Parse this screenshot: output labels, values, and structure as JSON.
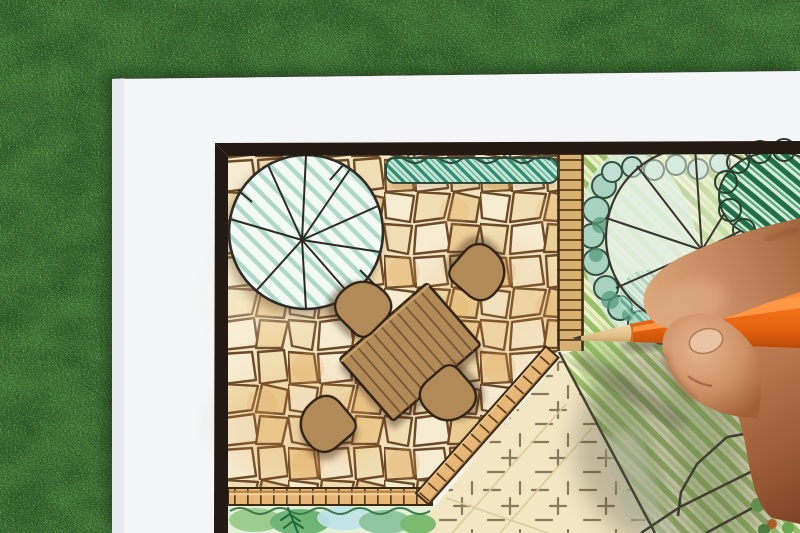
{
  "scene": {
    "type": "photograph",
    "description": "Overhead photo of a hand drawing a backyard garden landscape design plan with an orange colored pencil; the white plan sheet lies on green artificial grass",
    "background": {
      "label": "artificial grass lawn"
    },
    "paper": {
      "label": "white drawing paper sheet"
    },
    "plan": {
      "label": "hand-drawn garden plan with dark border",
      "elements": [
        {
          "name": "shade-tree-symbol",
          "desc": "large circular tree canopy with radiating branch lines, teal hatch, over patio corner"
        },
        {
          "name": "flagstone-patio",
          "desc": "irregular flagstone paving in warm tan watercolor with dark joints"
        },
        {
          "name": "hedge-row",
          "desc": "teal-green hatched hedge strip along the top edge"
        },
        {
          "name": "dining-table",
          "desc": "rectangular wooden plank table, plan view, rotated"
        },
        {
          "name": "chairs",
          "count": 4,
          "desc": "four rounded brown chairs around the table"
        },
        {
          "name": "timber-walkway",
          "desc": "vertical timber boardwalk with rung lines"
        },
        {
          "name": "brick-edging",
          "desc": "brick soldier-course edging along the patio, horizontal and diagonal runs"
        },
        {
          "name": "planting-bed",
          "desc": "green watercolor shrub bed with dark conifer sprig at bottom"
        },
        {
          "name": "gravel-area",
          "desc": "cream paved area with small cross and dash hatch marks"
        },
        {
          "name": "lawn",
          "desc": "diagonally hatched green pencil lawn"
        },
        {
          "name": "canopy-tree-symbol",
          "desc": "large tree circle with branch spokes over scalloped shrub cloud"
        },
        {
          "name": "dark-shrub",
          "desc": "dark green striped shrub mass at top right"
        },
        {
          "name": "rock-feature",
          "desc": "outlined rock and planting cluster, partly hidden by the hand"
        }
      ]
    },
    "foreground": {
      "hand": {
        "label": "right hand gripping the pencil"
      },
      "pencil": {
        "label": "orange colored pencil with sharpened tip",
        "color_name": "orange"
      }
    }
  },
  "colors": {
    "grass-dark": "#2e5c2a",
    "grass-mid": "#477c3c",
    "grass-light": "#7db35c",
    "paper": "#f3f5f7",
    "plan-paper": "#faf5e9",
    "border-ink": "#241a14",
    "stone-joint": "#6d4a28",
    "stone-a": "#f6ecd2",
    "stone-b": "#f0dfb4",
    "stone-c": "#ecd099",
    "stone-d": "#f3e6c4",
    "stone-tint": "#dd9a4e",
    "wood-table": "#b28a58",
    "wood-line": "#7a5430",
    "outline-ink": "#2f2416",
    "teal-hatch": "#2f8e72",
    "teal-base": "#cfe9dd",
    "tree-hatch": "#aed8c8",
    "tree-base": "#f3faf6",
    "walk-wood": "#d8b170",
    "walk-line": "#6a4826",
    "brick": "#e7b777",
    "brick-joint": "#5a3a1c",
    "bed-base": "#e2f0d8",
    "bed-dark": "#1f6b3a",
    "gravel": "#f3e6c2",
    "gravel-mark": "#8a7a5c",
    "lawn-base": "#edf1cb",
    "lawn-stripe": "#9cc06a",
    "lawn-dark": "#7fae56",
    "shrub-teal": "#a8d3c0",
    "shrub-ink": "#35503f",
    "dark-shrub": "#1f6f49",
    "pencil-orange": "#f0731c",
    "pencil-hi": "#ff9e4e",
    "pencil-lo": "#c2570e",
    "pencil-wood": "#ead2a2",
    "pencil-lead": "#453d34",
    "skin-hi": "#dba57f",
    "skin-mid": "#bc7a52",
    "skin-lo": "#8c4f31",
    "skin-deep": "#7a4026",
    "nail": "#e9c4a4",
    "shadow": "#57503f"
  }
}
